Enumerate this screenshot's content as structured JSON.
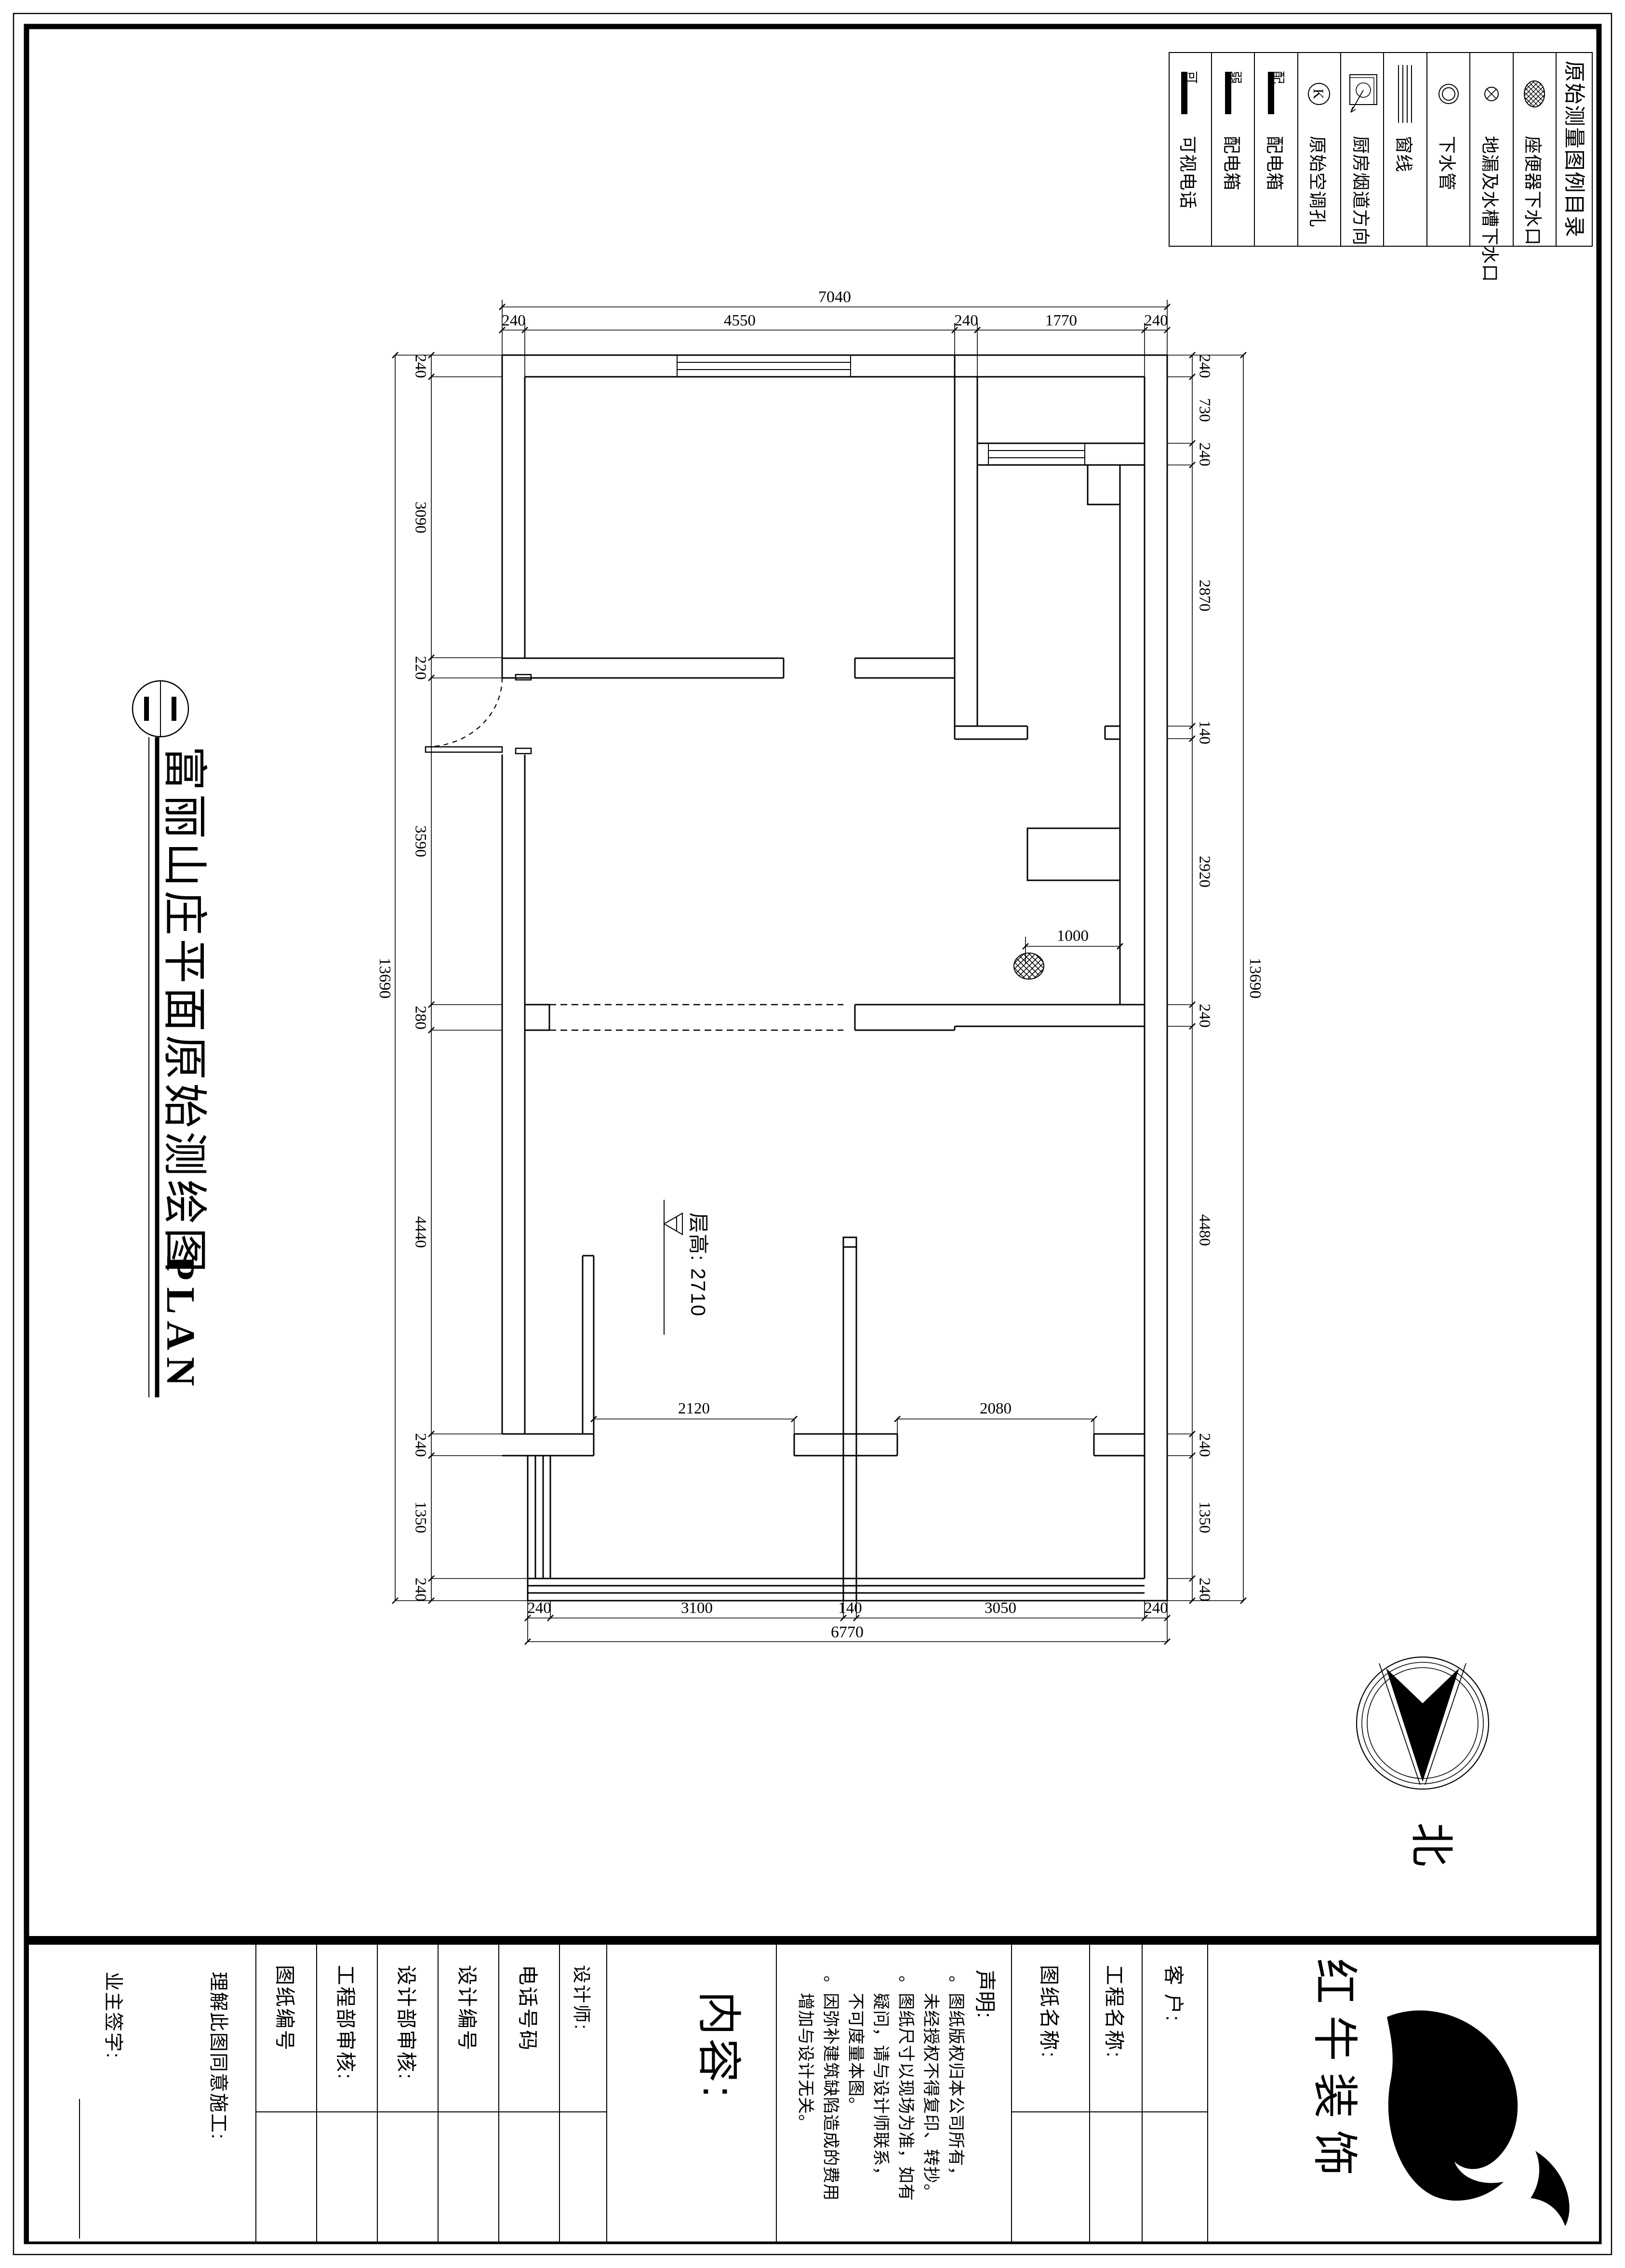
{
  "sheet": {
    "title": "富丽山庄平面原始测绘图",
    "subtitle": "PLAN",
    "north": "北",
    "floor_height": "层高: 2710"
  },
  "legend": {
    "title": "原始测量图例目录",
    "items": [
      {
        "label": "座便器下水口"
      },
      {
        "label": "地漏及水槽下水口"
      },
      {
        "label": "下水管"
      },
      {
        "label": "窗线"
      },
      {
        "label": "厨房烟道方向"
      },
      {
        "label": "原始空调孔",
        "letter": "K"
      },
      {
        "label": "配电箱",
        "letter": "配"
      },
      {
        "label": "配电箱",
        "letter": "弱"
      },
      {
        "label": "可视电话",
        "letter": "可"
      }
    ]
  },
  "dims": {
    "top_total": "7040",
    "top": [
      "240",
      "4550",
      "240",
      "1770",
      "240"
    ],
    "left_total": "13690",
    "left": [
      "240",
      "3090",
      "220",
      "3590",
      "280",
      "4440",
      "240",
      "1350",
      "240"
    ],
    "right": [
      "240",
      "730",
      "240",
      "2870",
      "140",
      "2920",
      "240",
      "4480",
      "240",
      "1350",
      "240"
    ],
    "right_total": "13690",
    "bottom": [
      "240",
      "3100",
      "140",
      "3050",
      "240"
    ],
    "bottom_total": "6770",
    "interior": {
      "left_room": "2120",
      "right_room": "2080",
      "drain": "1000"
    }
  },
  "titleblock": {
    "brand": "红 牛 装 饰",
    "customer": "客 户:",
    "project_name": "工程名称:",
    "drawing_name": "图纸名称:",
    "declaration_title": "声明:",
    "declaration_lines": [
      "。图纸版权归本公司所有，",
      "　未经授权不得复印、转抄。",
      "。图纸尺寸以现场为准，如有",
      "　疑问，请与设计师联系，",
      "　不可度量本图。",
      "。因弥补建筑缺陷造成的费用",
      "　增加与设计无关。"
    ],
    "content": "内容:",
    "designer": "设计师:",
    "phone": "电话号码",
    "design_no": "设计编号",
    "design_audit": "设计部审核:",
    "engineering_audit": "工程部审核:",
    "drawing_no": "图纸编号",
    "owner_line1": "理解此图同意施工:",
    "owner_line2": "业主签字:"
  }
}
